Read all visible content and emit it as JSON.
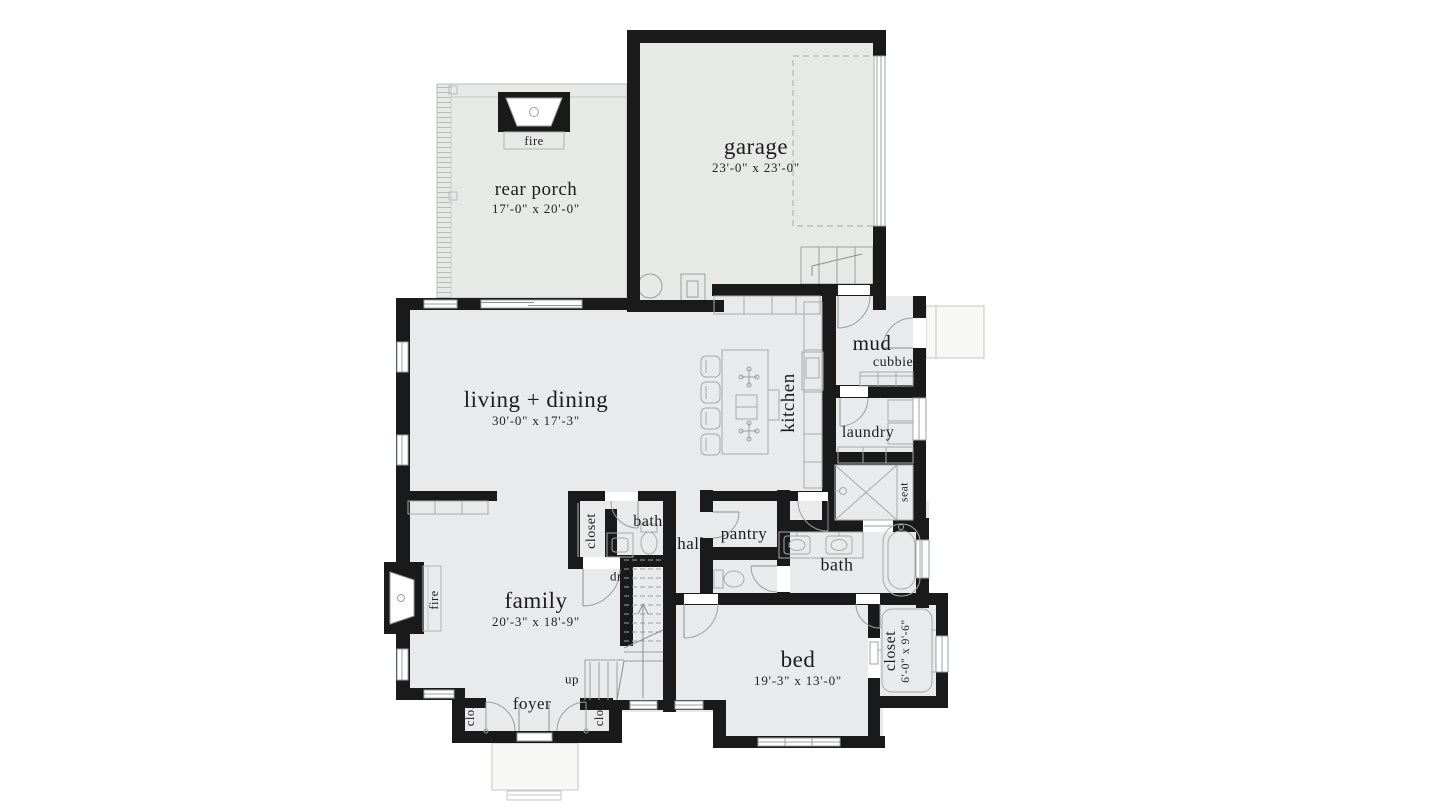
{
  "title": "floor-plan",
  "colors": {
    "wall": "#1a1a1a",
    "floor": "#e9eaeb",
    "porch_floor": "#e7e9e7",
    "fixture_line": "#a6abaa",
    "outdoor_fill": "#f7f8f6"
  },
  "rooms": {
    "garage": {
      "label": "garage",
      "dims": "23'-0\" x 23'-0\""
    },
    "rear_porch": {
      "label": "rear porch",
      "dims": "17'-0\" x 20'-0\""
    },
    "living_dining": {
      "label": "living + dining",
      "dims": "30'-0\" x 17'-3\""
    },
    "kitchen": {
      "label": "kitchen"
    },
    "mud": {
      "label": "mud"
    },
    "laundry": {
      "label": "laundry"
    },
    "pantry": {
      "label": "pantry"
    },
    "hall": {
      "label": "hall"
    },
    "bath_hall": {
      "label": "bath"
    },
    "closet_hall": {
      "label": "closet"
    },
    "bath_master": {
      "label": "bath"
    },
    "family": {
      "label": "family",
      "dims": "20'-3\" x 18'-9\""
    },
    "foyer": {
      "label": "foyer"
    },
    "bed": {
      "label": "bed",
      "dims": "19'-3\" x 13'-0\""
    },
    "closet_bed": {
      "label": "closet",
      "dims": "6'-0\" x 9'-6\""
    }
  },
  "annotations": {
    "fire_porch": "fire",
    "fire_family": "fire",
    "cubbies": "cubbies",
    "seat": "seat",
    "stair_down": "dn",
    "stair_up": "up",
    "closet_left": "clo.",
    "closet_right": "clo."
  }
}
